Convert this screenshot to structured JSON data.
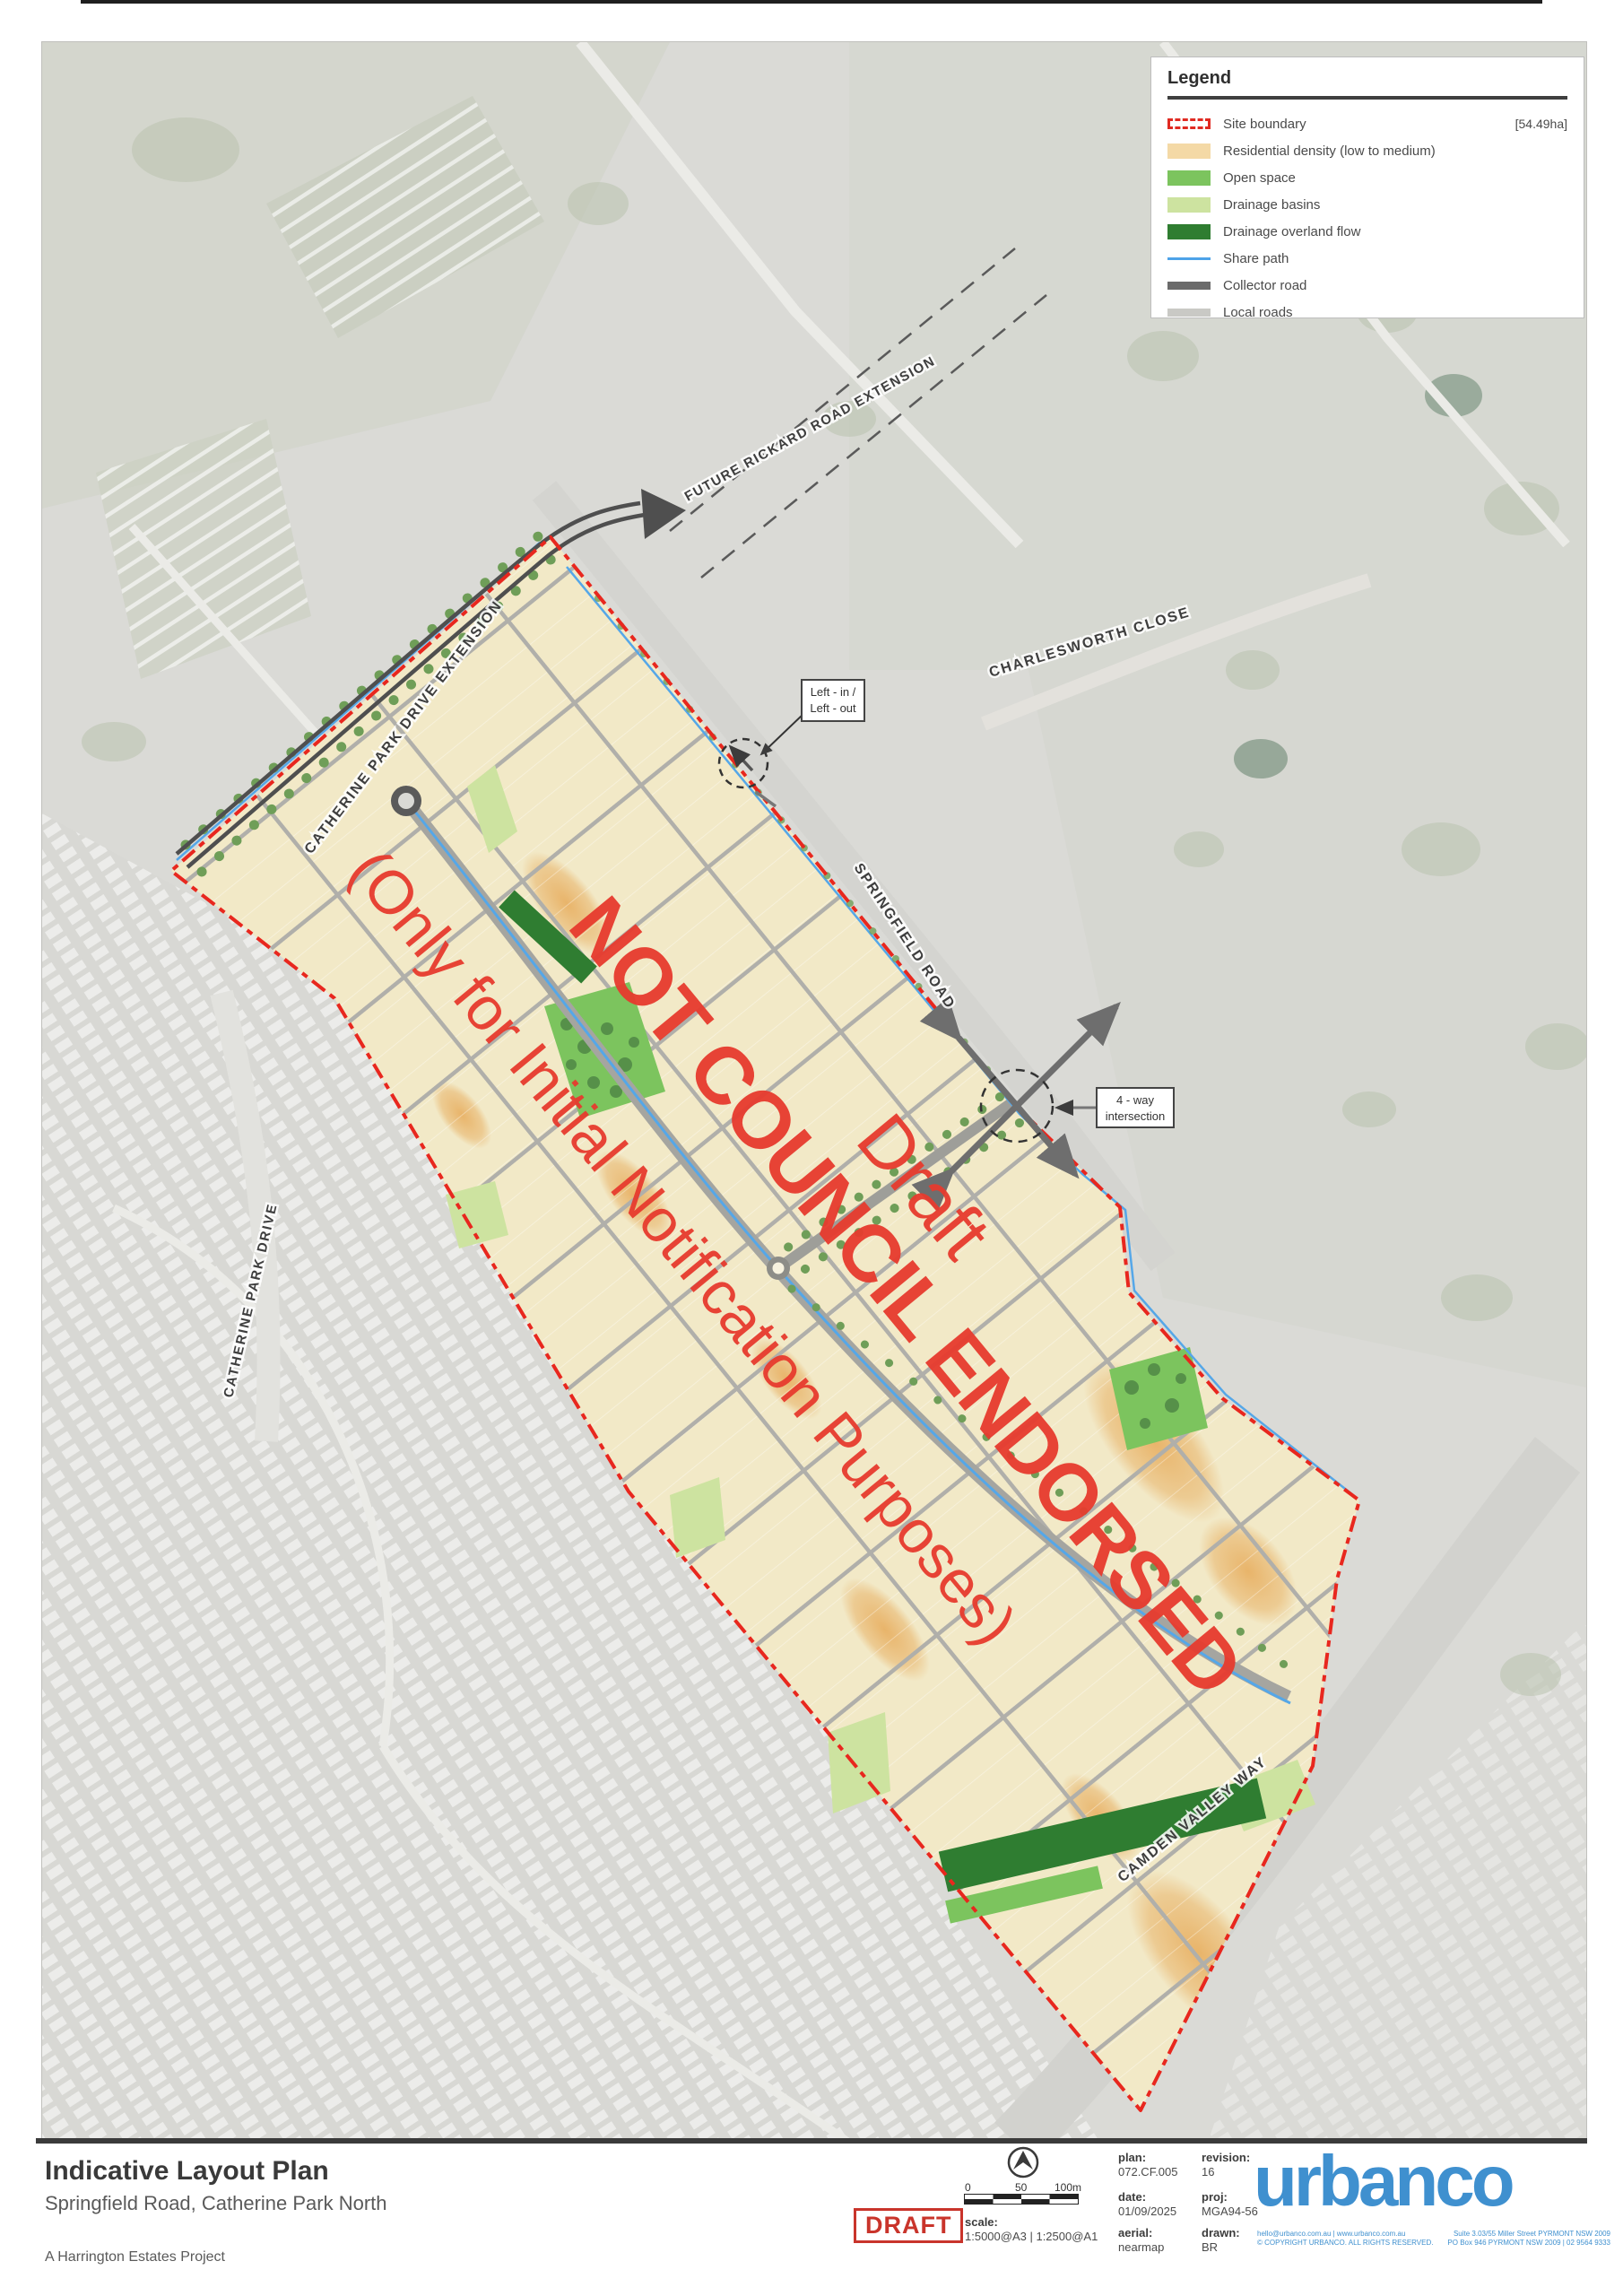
{
  "legend": {
    "title": "Legend",
    "area": "[54.49ha]",
    "items": [
      {
        "label": "Site boundary"
      },
      {
        "label": "Residential density (low to medium)"
      },
      {
        "label": "Open space"
      },
      {
        "label": "Drainage basins"
      },
      {
        "label": "Drainage overland flow"
      },
      {
        "label": "Share path"
      },
      {
        "label": "Collector road"
      },
      {
        "label": "Local roads"
      }
    ]
  },
  "watermark": {
    "line1": "NOT COUNCIL ENDORSED",
    "line2": "(Only for Initial Notification Purposes)",
    "line3": "Draft"
  },
  "roads": {
    "future_rickard": "FUTURE RICKARD ROAD EXTENSION",
    "catherine_ext": "CATHERINE PARK DRIVE EXTENSION",
    "charlesworth": "CHARLESWORTH CLOSE",
    "springfield": "SPRINGFIELD ROAD",
    "catherine_dr": "CATHERINE PARK DRIVE",
    "camden": "CAMDEN VALLEY WAY"
  },
  "callouts": {
    "left_in_1": "Left - in /",
    "left_in_2": "Left - out",
    "four_way_1": "4 - way",
    "four_way_2": "intersection"
  },
  "title_block": {
    "title": "Indicative Layout Plan",
    "subtitle": "Springfield Road, Catherine Park North",
    "project": "A Harrington Estates Project",
    "stamp": "DRAFT"
  },
  "scale_bar": {
    "t0": "0",
    "t50": "50",
    "t100": "100m"
  },
  "meta": {
    "scale_label": "scale:",
    "scale_value": "1:5000@A3 | 1:2500@A1",
    "plan_label": "plan:",
    "plan_value": "072.CF.005",
    "date_label": "date:",
    "date_value": "01/09/2025",
    "aerial_label": "aerial:",
    "aerial_value": "nearmap",
    "revision_label": "revision:",
    "revision_value": "16",
    "proj_label": "proj:",
    "proj_value": "MGA94-56",
    "drawn_label": "drawn:",
    "drawn_value": "BR"
  },
  "brand": {
    "logo": "urbanco",
    "contact_line1": "hello@urbanco.com.au | www.urbanco.com.au",
    "contact_line2": "© COPYRIGHT URBANCO. ALL RIGHTS RESERVED.",
    "address_line1": "Suite 3.03/55 Miller Street PYRMONT NSW 2009",
    "address_line2": "PO Box 946 PYRMONT NSW 2009 | 02 9564 9333"
  },
  "colors": {
    "boundary_red": "#e8271e",
    "watermark_red": "#e73b2e",
    "residential": "#f2e9c7",
    "open_space": "#7cc45e",
    "drainage_basin": "#cde3a0",
    "drainage_overland": "#2f7d31",
    "share_path": "#4da3e8",
    "collector": "#6b6b6b",
    "local_road": "#c9c9c5",
    "brand_blue": "#3f90cf",
    "draft_red": "#c9342b"
  }
}
